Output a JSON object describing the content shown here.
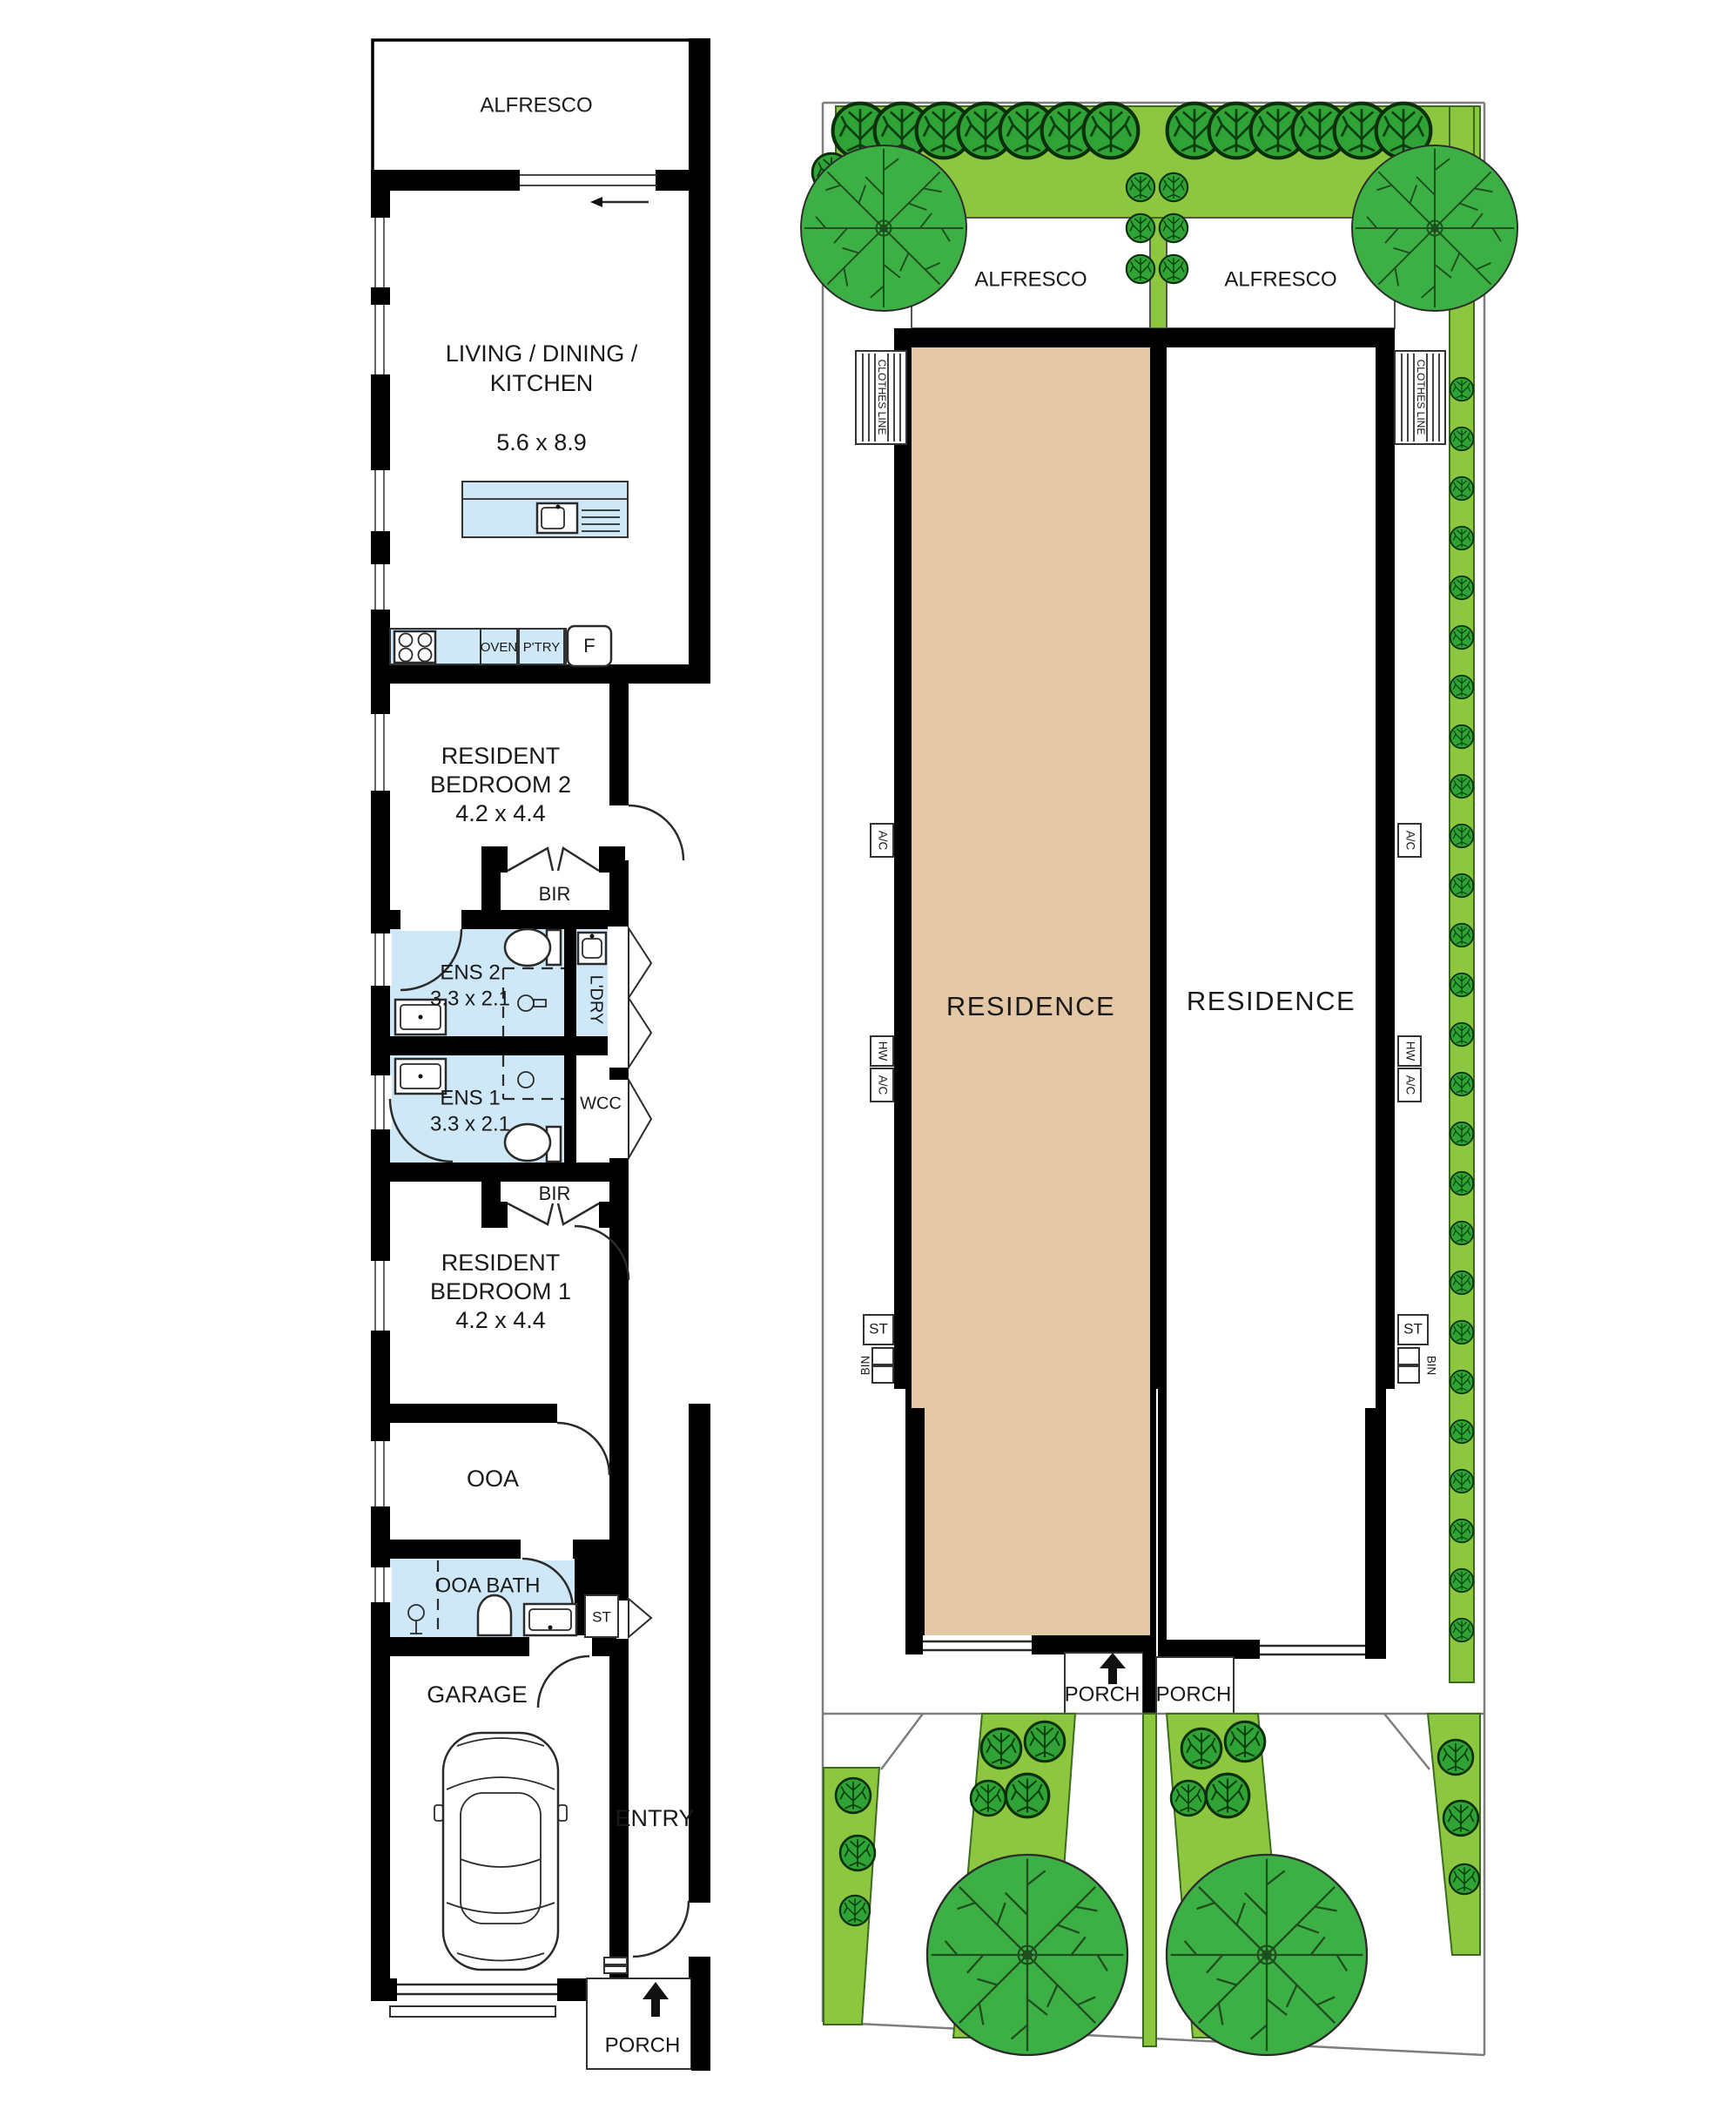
{
  "colors": {
    "wall": "#000000",
    "wet_area": "#cfe8f7",
    "residence_fill": "#e3c7a6",
    "lawn": "#8dc63f",
    "bush": "#2fa336",
    "bush_detail": "#083d0c",
    "tree": "#3cb044",
    "tree_detail": "#1e4d1e",
    "boundary": "#7d7d7d"
  },
  "floor_plan": {
    "alfresco": "ALFRESCO",
    "living": {
      "line1": "LIVING / DINING /",
      "line2": "KITCHEN",
      "dims": "5.6 x 8.9"
    },
    "kitchen": {
      "oven": "OVEN",
      "pantry": "P'TRY",
      "fridge": "F"
    },
    "bedroom2": {
      "line1": "RESIDENT",
      "line2": "BEDROOM 2",
      "dims": "4.2 x 4.4"
    },
    "bir_upper": "BIR",
    "ens2": {
      "name": "ENS 2",
      "dims": "3.3 x 2.1"
    },
    "laundry": "L'DRY",
    "ens1": {
      "name": "ENS 1",
      "dims": "3.3 x 2.1"
    },
    "wcc": "WCC",
    "bir_lower": "BIR",
    "bedroom1": {
      "line1": "RESIDENT",
      "line2": "BEDROOM 1",
      "dims": "4.2 x 4.4"
    },
    "ooa": "OOA",
    "ooa_bath": "OOA BATH",
    "storage": "ST",
    "garage": "GARAGE",
    "entry": "ENTRY",
    "porch": "PORCH"
  },
  "site_plan": {
    "lot_left": {
      "alfresco": "ALFRESCO",
      "residence": "RESIDENCE",
      "clothes_line": "CLOTHES LINE",
      "ac": "A/C",
      "hw": "HW",
      "hw_ac": "A/C",
      "st": "ST",
      "bin": "BIN",
      "porch": "PORCH"
    },
    "lot_right": {
      "alfresco": "ALFRESCO",
      "residence": "RESIDENCE",
      "clothes_line": "CLOTHES LINE",
      "ac": "A/C",
      "hw": "HW",
      "hw_ac": "A/C",
      "st": "ST",
      "bin": "BIN",
      "porch": "PORCH"
    }
  }
}
